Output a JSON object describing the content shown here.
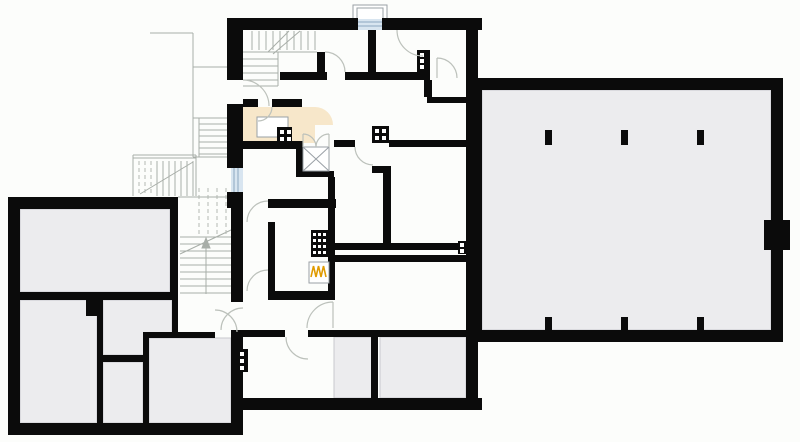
{
  "page": {
    "title": "Basement floor plan drawing",
    "background": "#fcfdfb"
  },
  "colors": {
    "wall": "#0b0b0b",
    "room_gray": "#ececee",
    "room_gray_border": "#c9c9cd",
    "room_beige": "#f7e7ca",
    "white": "#ffffff",
    "thin_line": "#a8aea8",
    "dash_line": "#b3b9b3",
    "door_arc": "#bcc1bb",
    "window_glass": "#d8e5f0",
    "window_frame": "#8ba6c1",
    "symbol_border": "#9aa0a6",
    "heater_flame": "#e09b00",
    "chimney_dot": "#ffffff"
  },
  "plan": {
    "drawing_type": "basement floor plan",
    "gray_room_count": 8,
    "column_pier_count": 6,
    "chimney_flue_count": 6,
    "window_count": 2,
    "symbols": [
      "wall",
      "door-swing-arc",
      "window",
      "window-well",
      "chimney-flue",
      "ventilation-shaft-x",
      "heater-flame",
      "stair-treads",
      "column-pier",
      "counter"
    ]
  }
}
